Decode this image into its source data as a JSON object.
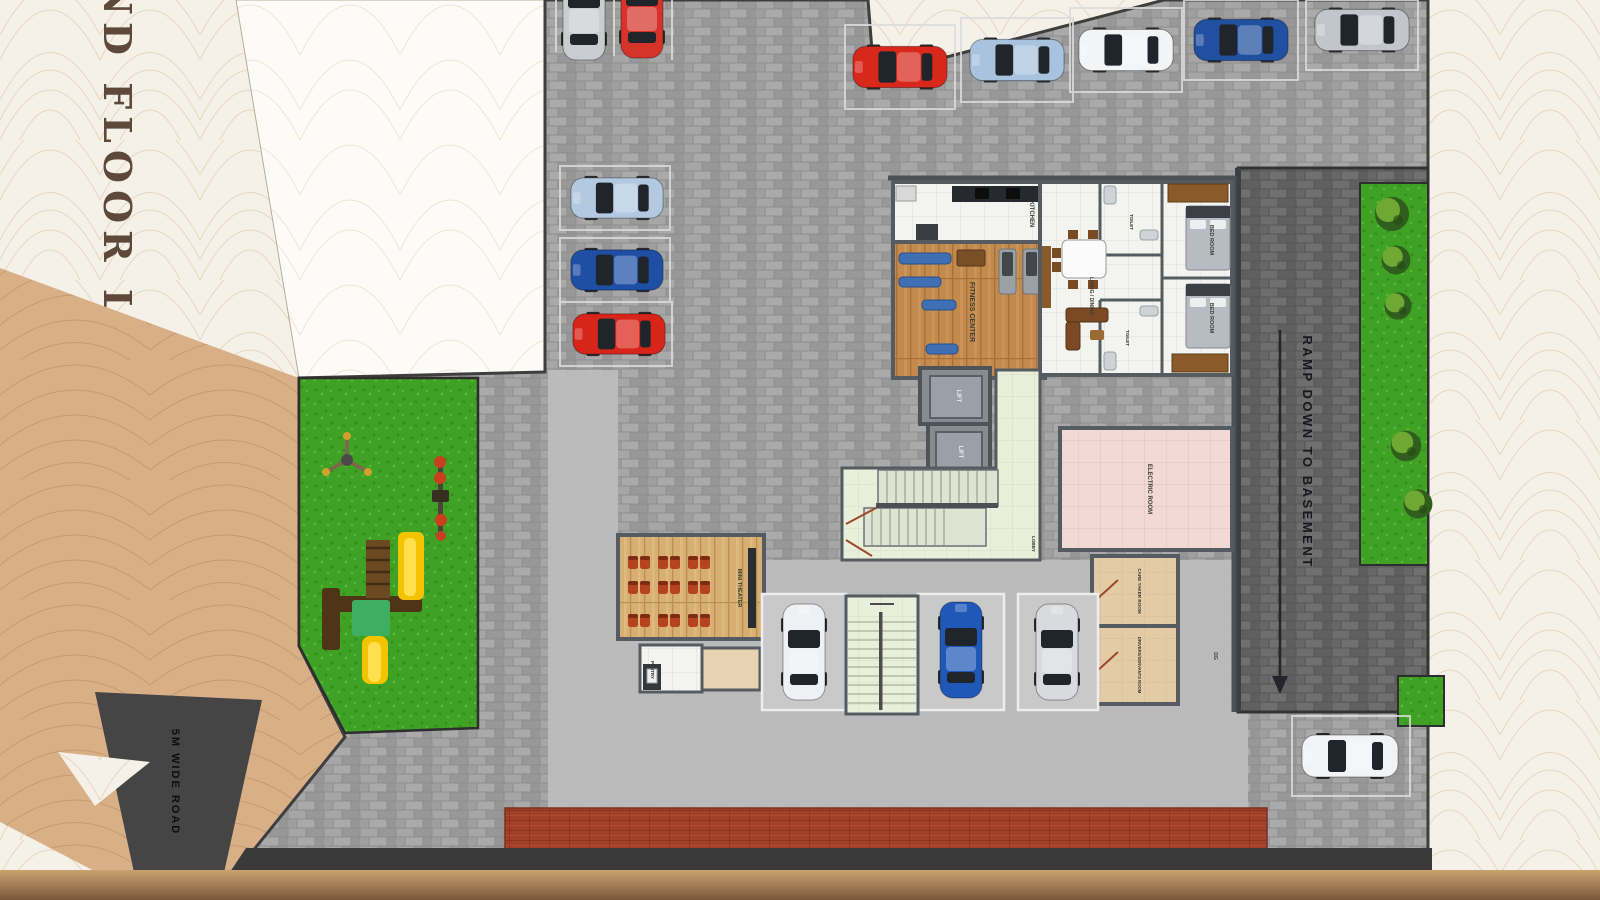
{
  "page": {
    "title_vertical": "GROUND FLOOR LAYOUT"
  },
  "site": {
    "ramp_label": "RAMP DOWN TO BASEMENT",
    "road_label": "5M WIDE ROAD"
  },
  "rooms": {
    "kitchen": {
      "label": "KITCHEN"
    },
    "fitness": {
      "label": "FITNESS CENTER"
    },
    "sit_out": {
      "label": "SIT OUT"
    },
    "living_dining": {
      "label": "LIVING / DINING"
    },
    "bedroom_1": {
      "label": "BED ROOM"
    },
    "bedroom_2": {
      "label": "BED ROOM"
    },
    "toilet_1": {
      "label": "TOILET"
    },
    "toilet_2": {
      "label": "TOILET"
    },
    "lift_1": {
      "label": "LIFT"
    },
    "lift_2": {
      "label": "LIFT"
    },
    "lobby": {
      "label": "LOBBY"
    },
    "electric": {
      "label": "ELECTRIC ROOM"
    },
    "mini_theater": {
      "label": "MINI THEATER"
    },
    "pantry": {
      "label": "PANTRY"
    },
    "care_taker": {
      "label": "CARE TAKER ROOM"
    },
    "drivers": {
      "label": "DRIVERS/SERVANTS ROOM"
    },
    "dg": {
      "label": "DG"
    }
  },
  "cars": [
    {
      "id": "top-cut-silver",
      "color": "#c9cdd2"
    },
    {
      "id": "top-cut-red",
      "color": "#d6332a"
    },
    {
      "id": "toprow-red",
      "color": "#d8281c"
    },
    {
      "id": "toprow-lightblue",
      "color": "#a9c3de"
    },
    {
      "id": "toprow-white",
      "color": "#f3f4f6"
    },
    {
      "id": "toprow-darkblue",
      "color": "#20509f"
    },
    {
      "id": "toprow-grey",
      "color": "#c2c6cc"
    },
    {
      "id": "left-lightblue",
      "color": "#b3c9e2"
    },
    {
      "id": "left-darkblue",
      "color": "#1f4fa5"
    },
    {
      "id": "left-red",
      "color": "#d8251a"
    },
    {
      "id": "bay-white",
      "color": "#eef0f3"
    },
    {
      "id": "bay-blue",
      "color": "#2058b8"
    },
    {
      "id": "bay-silver",
      "color": "#d8dadd"
    },
    {
      "id": "corner-white",
      "color": "#f2f3f5"
    }
  ],
  "palette": {
    "background": "#f6f1e8",
    "tan_ground": "#d9af87",
    "paving": "#9d9d9d",
    "paving_dark": "#6a6a6a",
    "grass": "#3fa224",
    "road": "#454545",
    "red_strip": "#a2402a",
    "electric_pink": "#f2d9d4",
    "lobby_green": "#e9efdb",
    "wood": "#c38a4e",
    "wall": "#565b62",
    "title_brown": "#5d483a"
  }
}
